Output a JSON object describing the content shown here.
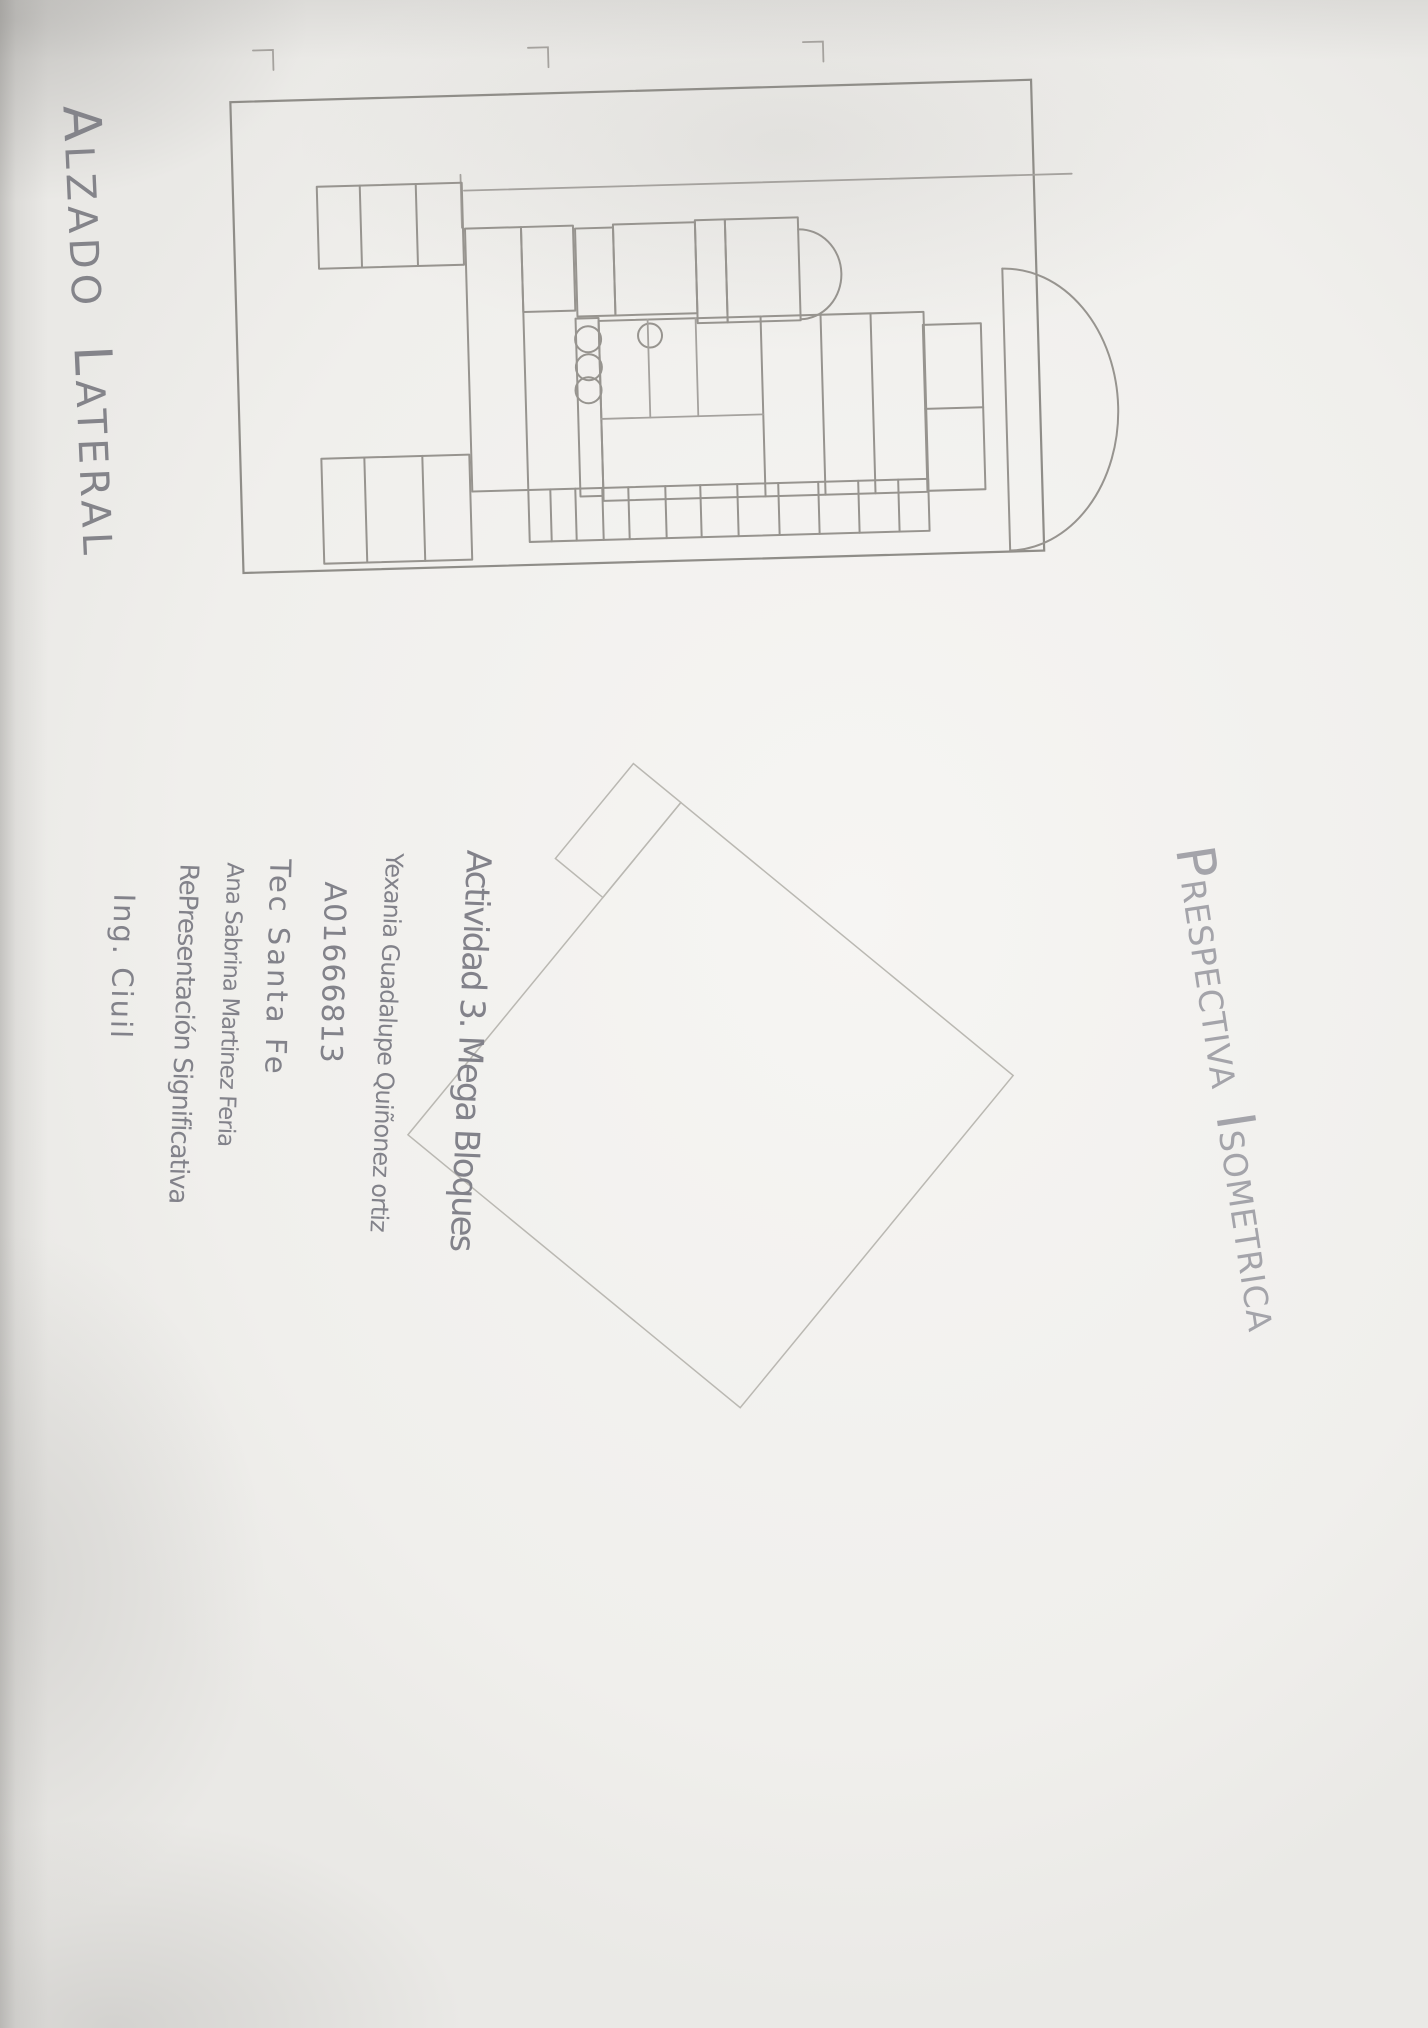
{
  "photo": {
    "paper_color": "#f1f0ee",
    "pencil_color": "#97948f",
    "pencil_light_color": "#bab8b2",
    "handwriting_color": "#82828a"
  },
  "elevation": {
    "title_a_initial": "A",
    "title_a_rest": "LZADO",
    "title_l_initial": "L",
    "title_l_rest": "ATERAL",
    "title_full": "ALZADO LATERAL"
  },
  "perspective": {
    "title_p_initial": "P",
    "title_p_rest": "RESPECTIVA",
    "title_i_initial": "I",
    "title_i_rest": "SOMETRICA",
    "title_full": "PRESPECTIVA ISOMETRICA"
  },
  "info": {
    "lines": [
      "Actividad 3. Mega Bloques",
      "Yexania Guadalupe Quiñonez ortiz",
      "A01666813",
      "Tec Santa Fe",
      "Ana Sabrina Martinez Feria",
      "RePresentación Significativa",
      "Ing. Ciuil"
    ]
  }
}
